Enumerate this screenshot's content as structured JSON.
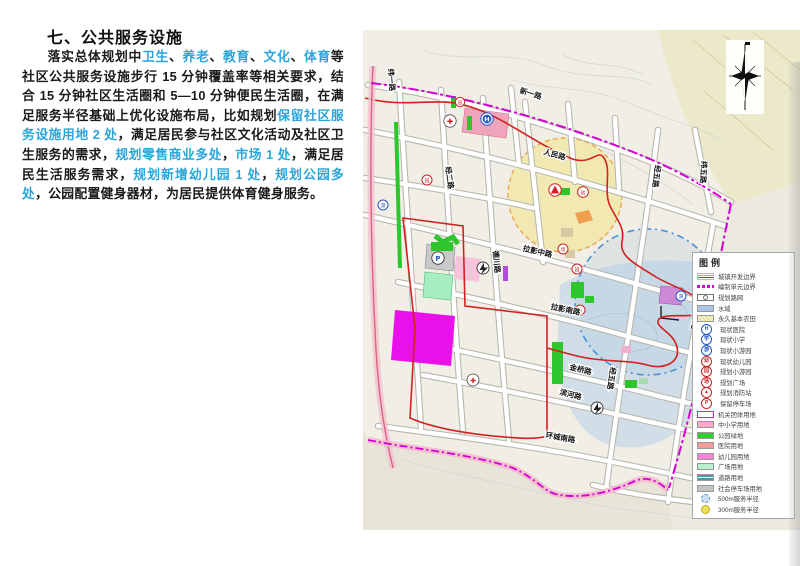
{
  "title": "七、公共服务设施",
  "paragraph": {
    "segments": [
      {
        "t": "落实总体规划中"
      },
      {
        "t": "卫生"
      },
      {
        "t": "、"
      },
      {
        "t": "养老"
      },
      {
        "t": "、"
      },
      {
        "t": "教育"
      },
      {
        "t": "、"
      },
      {
        "t": "文化"
      },
      {
        "t": "、"
      },
      {
        "t": "体育"
      },
      {
        "t": "等社区公共服务设施步行 15 分钟覆盖率等相关要求，结合 15 分钟社区生活圈和 5—10 分钟便民生活圈，在满足服务半径基础上优化设施布局，比如规划"
      },
      {
        "t": "保留社区服务设施用地 2 处"
      },
      {
        "t": "，满足居民参与社区文化活动及社区卫生服务的需求，"
      },
      {
        "t": "规划零售商业多处"
      },
      {
        "t": "，"
      },
      {
        "t": "市场 1 处"
      },
      {
        "t": "，满足居民生活服务需求，"
      },
      {
        "t": "规划新增幼儿园 1 处"
      },
      {
        "t": "，"
      },
      {
        "t": "规划公园多处"
      },
      {
        "t": "，公园配置健身器材，为居民提供体育健身服务。"
      }
    ]
  },
  "colors": {
    "highlight_blue": "#29a5dc",
    "boundary_red": "#d42020",
    "boundary_magenta": "#d400d4",
    "radius_yellow_fill": "#f3e9b0",
    "radius_blue_stroke": "#4a90d9"
  },
  "map": {
    "road_labels": [
      {
        "text": "新一路"
      },
      {
        "text": "人民路"
      },
      {
        "text": "拉影中路"
      },
      {
        "text": "拉影南路"
      },
      {
        "text": "金桥路"
      },
      {
        "text": "滨河路"
      },
      {
        "text": "环城南路"
      },
      {
        "text": "经二路"
      },
      {
        "text": "德川路"
      },
      {
        "text": "经五路"
      },
      {
        "text": "经五路"
      },
      {
        "text": "经六路"
      },
      {
        "text": "纬一路"
      },
      {
        "text": "纬五路"
      }
    ],
    "icons": [
      {
        "glyph": "H"
      },
      {
        "glyph": "✚"
      },
      {
        "glyph": "园"
      },
      {
        "glyph": "园"
      },
      {
        "glyph": "游"
      },
      {
        "glyph": "幼"
      },
      {
        "glyph": "P"
      },
      {
        "glyph": "场"
      },
      {
        "glyph": "园"
      },
      {
        "glyph": "场"
      },
      {
        "glyph": "游"
      },
      {
        "glyph": "✚"
      }
    ]
  },
  "legend": {
    "title": "图例",
    "items": [
      {
        "label": "城镇开发边界"
      },
      {
        "label": "编制单元边界"
      },
      {
        "label": "规划路网"
      },
      {
        "label": "水域",
        "color": "#a9c6e8"
      },
      {
        "label": "永久基本农田",
        "color": "#f5f0c0"
      },
      {
        "label": "现状医院",
        "color": "#2255cc",
        "glyph": "H"
      },
      {
        "label": "现状小学",
        "color": "#2255cc",
        "glyph": "学"
      },
      {
        "label": "现状小游园",
        "color": "#2255cc",
        "glyph": "游"
      },
      {
        "label": "现状幼儿园",
        "color": "#cc2222",
        "glyph": "幼"
      },
      {
        "label": "规划小游园",
        "color": "#cc2222",
        "glyph": "园"
      },
      {
        "label": "规划广场",
        "color": "#cc2222",
        "glyph": "场"
      },
      {
        "label": "规划消防站",
        "color": "#cc2222",
        "glyph": "▲"
      },
      {
        "label": "保留停车场",
        "color": "#cc2222",
        "glyph": "P"
      },
      {
        "label": "机关团体用地",
        "color": "#e010e0"
      },
      {
        "label": "中小学用地",
        "color": "#f8a8c8"
      },
      {
        "label": "公园绿地",
        "color": "#33cc33"
      },
      {
        "label": "医院用地",
        "color": "#f49a9a"
      },
      {
        "label": "幼儿园用地",
        "color": "#f985d8"
      },
      {
        "label": "广场用地",
        "color": "#b8f0cc"
      },
      {
        "label": "道路用地",
        "color": "#4a9aa8"
      },
      {
        "label": "社会停车场用地",
        "color": "#c4c4c4"
      },
      {
        "label": "500m服务半径",
        "color": "#4a90d9"
      },
      {
        "label": "300m服务半径",
        "color": "#ece04e"
      }
    ]
  }
}
